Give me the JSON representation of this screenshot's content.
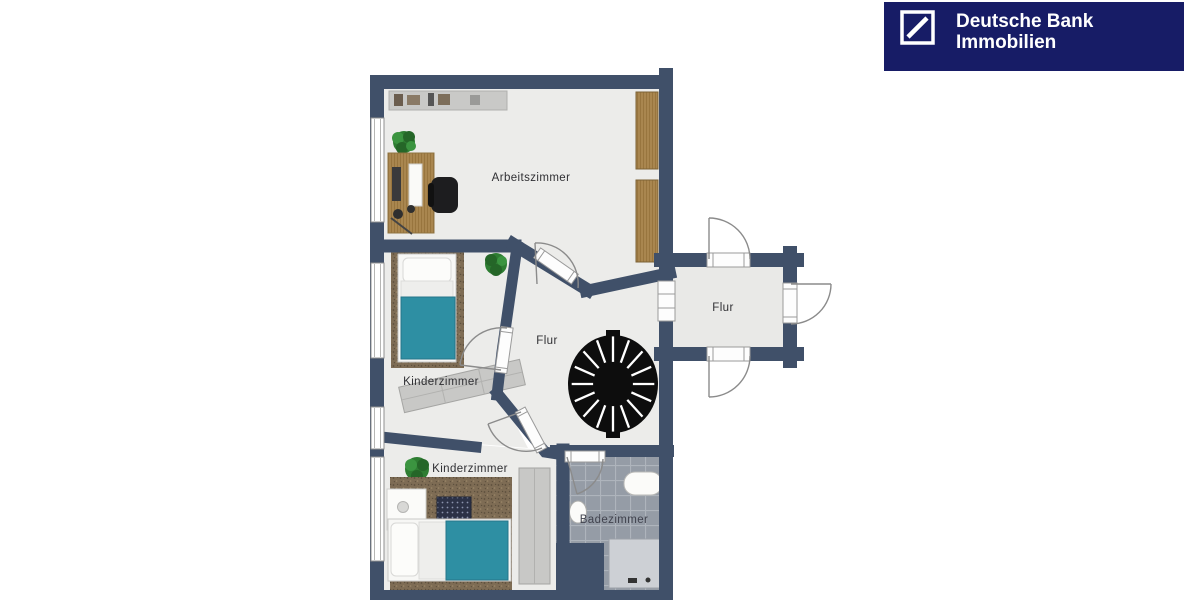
{
  "logo": {
    "brand_line1": "Deutsche Bank",
    "brand_line2": "Immobilien",
    "mark": "deutsche-bank-slash-logo"
  },
  "floorplan": {
    "rooms": {
      "arbeitszimmer": {
        "label": "Arbeitszimmer"
      },
      "kinderzimmer_mitte": {
        "label": "Kinderzimmer"
      },
      "kinderzimmer_unten": {
        "label": "Kinderzimmer"
      },
      "flur_haupt": {
        "label": "Flur"
      },
      "flur_eingang": {
        "label": "Flur"
      },
      "badezimmer": {
        "label": "Badezimmer"
      }
    },
    "fixtures": [
      "spiral-staircase",
      "bathtub",
      "toilet",
      "shower",
      "bed",
      "bed",
      "desk",
      "office-chair",
      "wardrobe",
      "wardrobe",
      "shelf",
      "nightstand",
      "plant",
      "plant",
      "plant"
    ]
  },
  "colors": {
    "wall": "#405069",
    "floor": "#ECECEA",
    "floor_entry": "#E9E9E7",
    "carpet_base": "#7E6C54",
    "teal_blanket": "#2E8FA3",
    "wood_base": "#A9864F",
    "tile_base": "#959CA6",
    "shower": "#CDD0D5",
    "stair_black": "#0D0D0D",
    "logo_bg": "#171C66",
    "logo_text": "#FFFFFF",
    "label_text": "#2F2F33"
  }
}
